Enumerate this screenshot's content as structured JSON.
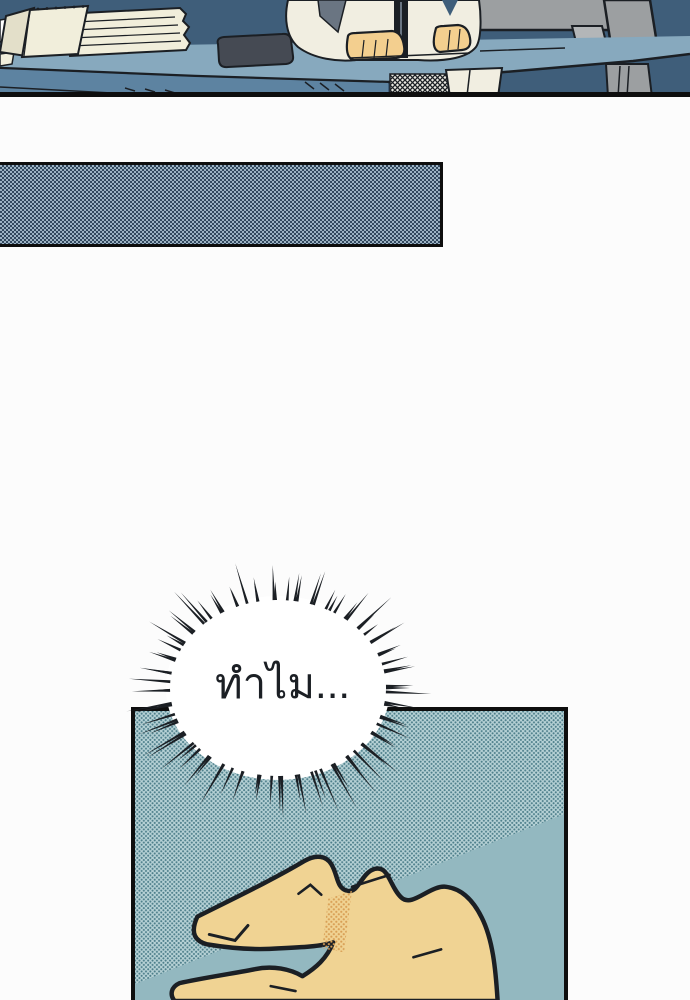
{
  "page": {
    "kind": "webtoon comic page",
    "background_color": "#fcfcfc"
  },
  "speech_bubble": {
    "text": "ทำไม...",
    "shape": "burst ellipse with radiating spikes",
    "fill": "#ffffff"
  },
  "caption_box": {
    "text": "",
    "style": "empty halftone-filled narration box"
  },
  "panel_desk_scene": {
    "objects": [
      "flip notepad",
      "stack of papers",
      "dark glasses case",
      "person in white shirt with hands on desk",
      "monitor seen from behind",
      "office desk",
      "mesh chair back",
      "desk leg"
    ]
  },
  "panel_hand": {
    "objects": [
      "hand poised to flick, thumb and index finger forming a C",
      "diagonal light band in halftone background"
    ]
  },
  "colors": {
    "page_bg": "#fcfcfc",
    "ink": "#1b1f24",
    "panel_border": "#0e0e0e",
    "navy_bg": "#3f5e7a",
    "desk_top": "#87a9be",
    "desk_front": "#5d83a1",
    "paper": "#f1eedb",
    "paper_shadow": "#e3dfc9",
    "shirt": "#f1eee1",
    "hand_skin": "#f3cf8f",
    "monitor_gray": "#9c9fa1",
    "monitor_light": "#b3b6b8",
    "case_dark": "#454a53",
    "chair_gray": "#6a7582",
    "mesh_bg": "#e9e8e0",
    "halftone_light": "#9cb2c3",
    "halftone_dark": "#32485e",
    "teal_base": "#b7d2d6",
    "teal_dot": "#4e7f8b",
    "teal_smooth": "#93b8c0",
    "flick_skin": "#f0d393",
    "shade_dot": "#d89f55"
  }
}
